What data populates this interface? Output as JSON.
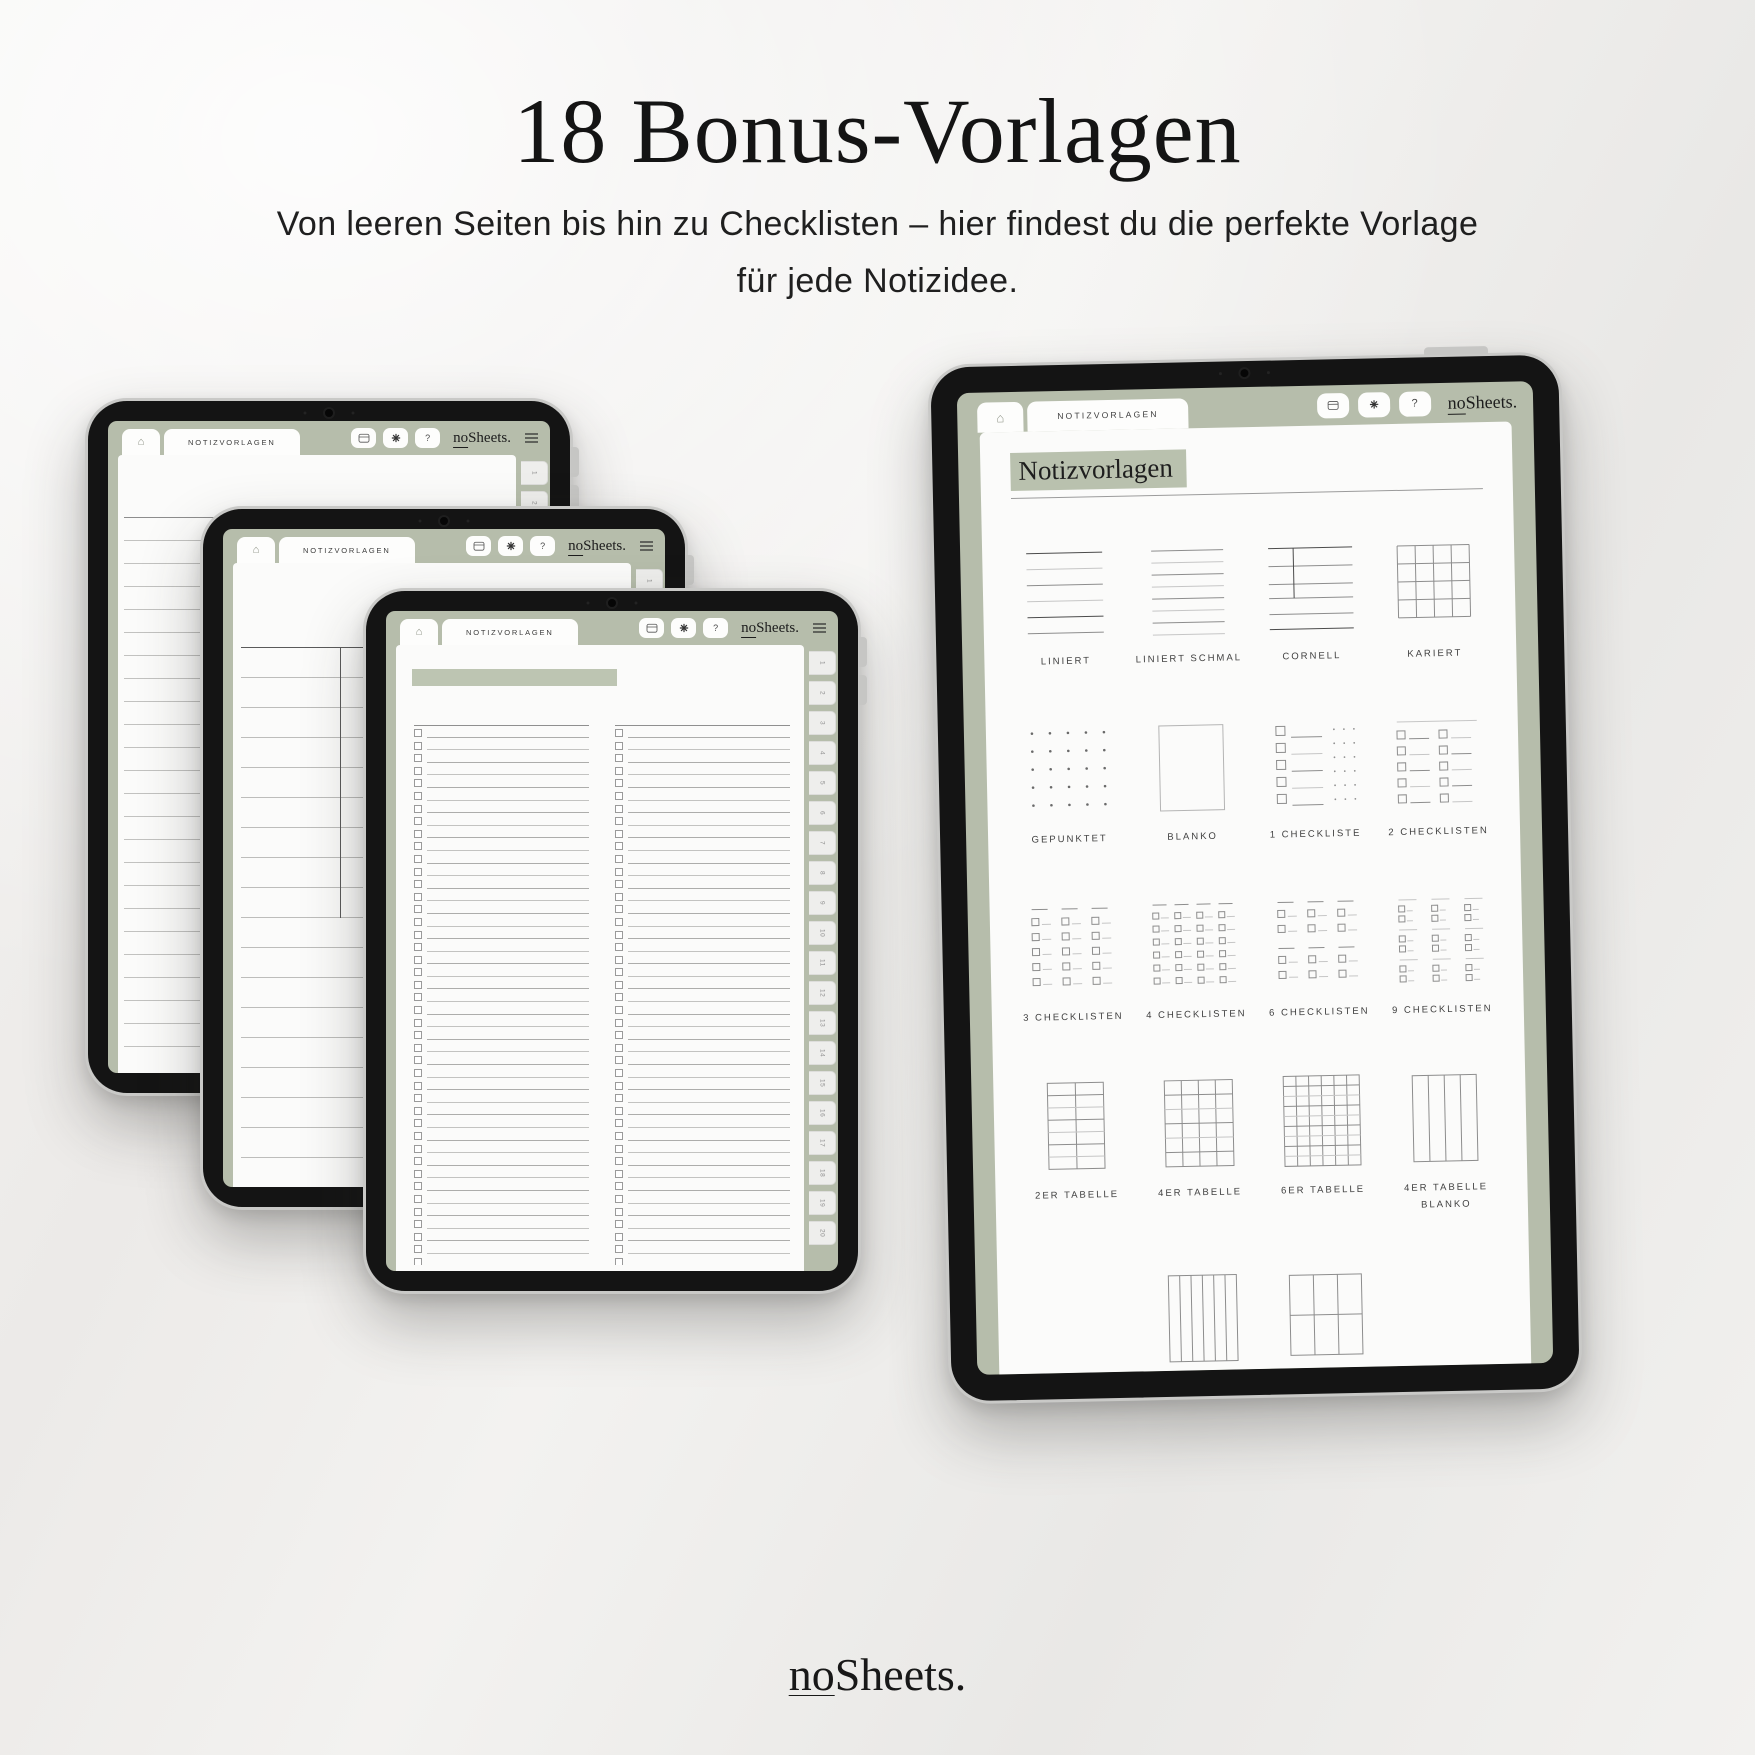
{
  "page": {
    "title": "18 Bonus-Vorlagen",
    "subtitle_line1": "Von leeren Seiten bis hin zu Checklisten – hier findest du die perfekte Vorlage",
    "subtitle_line2": "für jede Notizidee."
  },
  "colors": {
    "sage": "#b6bdab",
    "sage_highlight": "#b9c1ae",
    "background": "#efeeec",
    "ink": "#141414",
    "paper": "#fbfbfa"
  },
  "tablet_ui": {
    "home_glyph": "⌂",
    "tab_label": "NOTIZVORLAGEN",
    "logo_prefix": "no",
    "logo_suffix": "Sheets.",
    "help_glyph": "?",
    "toolbar_icons": [
      "calendar-icon",
      "gear-icon",
      "help-icon"
    ],
    "menu_icon": "hamburger-icon"
  },
  "left_tablets": {
    "back_template": "liniert",
    "middle_template": "cornell",
    "front_template": "2 checklisten",
    "page_tabs": [
      "1",
      "2",
      "3",
      "4",
      "5",
      "6",
      "7",
      "8",
      "9",
      "10",
      "11",
      "12",
      "13",
      "14",
      "15",
      "16",
      "17",
      "18",
      "19",
      "20"
    ]
  },
  "right_tablet": {
    "heading": "Notizvorlagen",
    "templates": [
      {
        "label": "LINIERT",
        "kind": "lined"
      },
      {
        "label": "LINIERT SCHMAL",
        "kind": "lined-narrow"
      },
      {
        "label": "CORNELL",
        "kind": "cornell"
      },
      {
        "label": "KARIERT",
        "kind": "squared"
      },
      {
        "label": "GEPUNKTET",
        "kind": "dotted"
      },
      {
        "label": "BLANKO",
        "kind": "blank"
      },
      {
        "label": "1 CHECKLISTE",
        "kind": "checklist-1"
      },
      {
        "label": "2 CHECKLISTEN",
        "kind": "checklist-2"
      },
      {
        "label": "3 CHECKLISTEN",
        "kind": "checklist-3"
      },
      {
        "label": "4 CHECKLISTEN",
        "kind": "checklist-4"
      },
      {
        "label": "6 CHECKLISTEN",
        "kind": "checklist-6"
      },
      {
        "label": "9 CHECKLISTEN",
        "kind": "checklist-9"
      },
      {
        "label": "2ER TABELLE",
        "kind": "table-2"
      },
      {
        "label": "4ER TABELLE",
        "kind": "table-4"
      },
      {
        "label": "6ER TABELLE",
        "kind": "table-6"
      },
      {
        "label": "4ER TABELLE BLANKO",
        "kind": "table-4-blank"
      },
      {
        "label": "6ER TABELLE BLANKO",
        "kind": "table-6-blank"
      },
      {
        "label": "RASTER BLANKO",
        "kind": "raster-blank"
      }
    ]
  },
  "footer": {
    "logo_prefix": "no",
    "logo_suffix": "Sheets."
  }
}
